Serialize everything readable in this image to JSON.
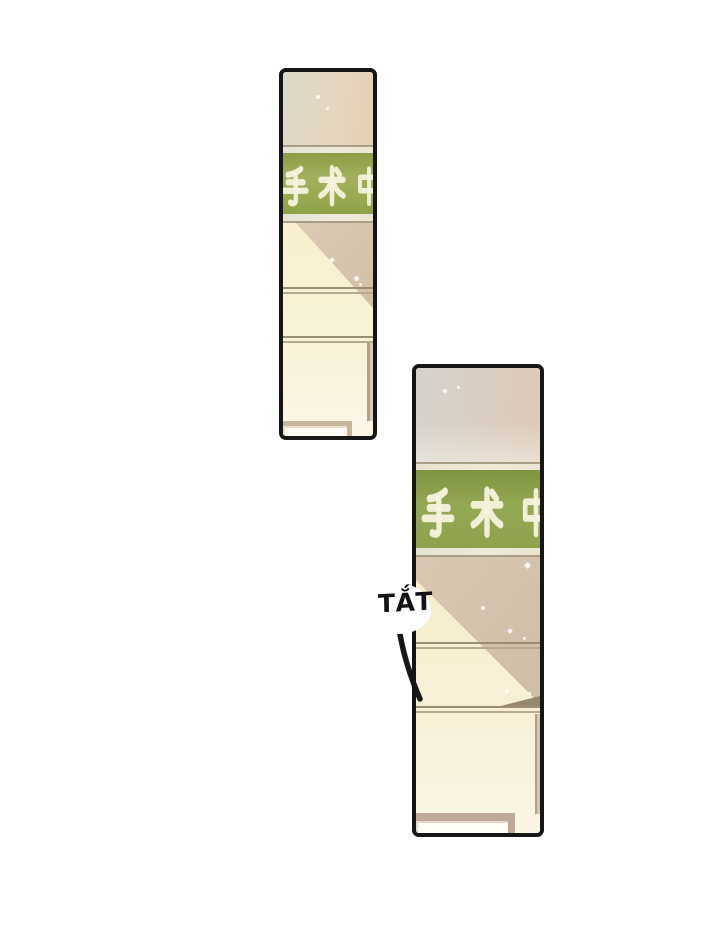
{
  "comic": {
    "panels": [
      {
        "id": "panel-top",
        "sign": {
          "text": "手术中"
        }
      },
      {
        "id": "panel-bottom",
        "sign": {
          "text": "手术中"
        },
        "sfx": {
          "text": "TẮT"
        }
      }
    ],
    "colors": {
      "page_bg": "#ffffff",
      "panel_border": "#161616",
      "sign_green": "#95a84f",
      "sign_text": "#f5f2dd",
      "sign_strip": "#ece8d8",
      "wall_cream": "#f7efcd",
      "wall_shadow": "#d8c5ae",
      "trim_line": "#9c8e74",
      "door_frame_top": "#c7b49a",
      "door_frame_bottom": "#bfa899",
      "door_white": "#fefcf4",
      "sfx_ink": "#141414"
    }
  }
}
